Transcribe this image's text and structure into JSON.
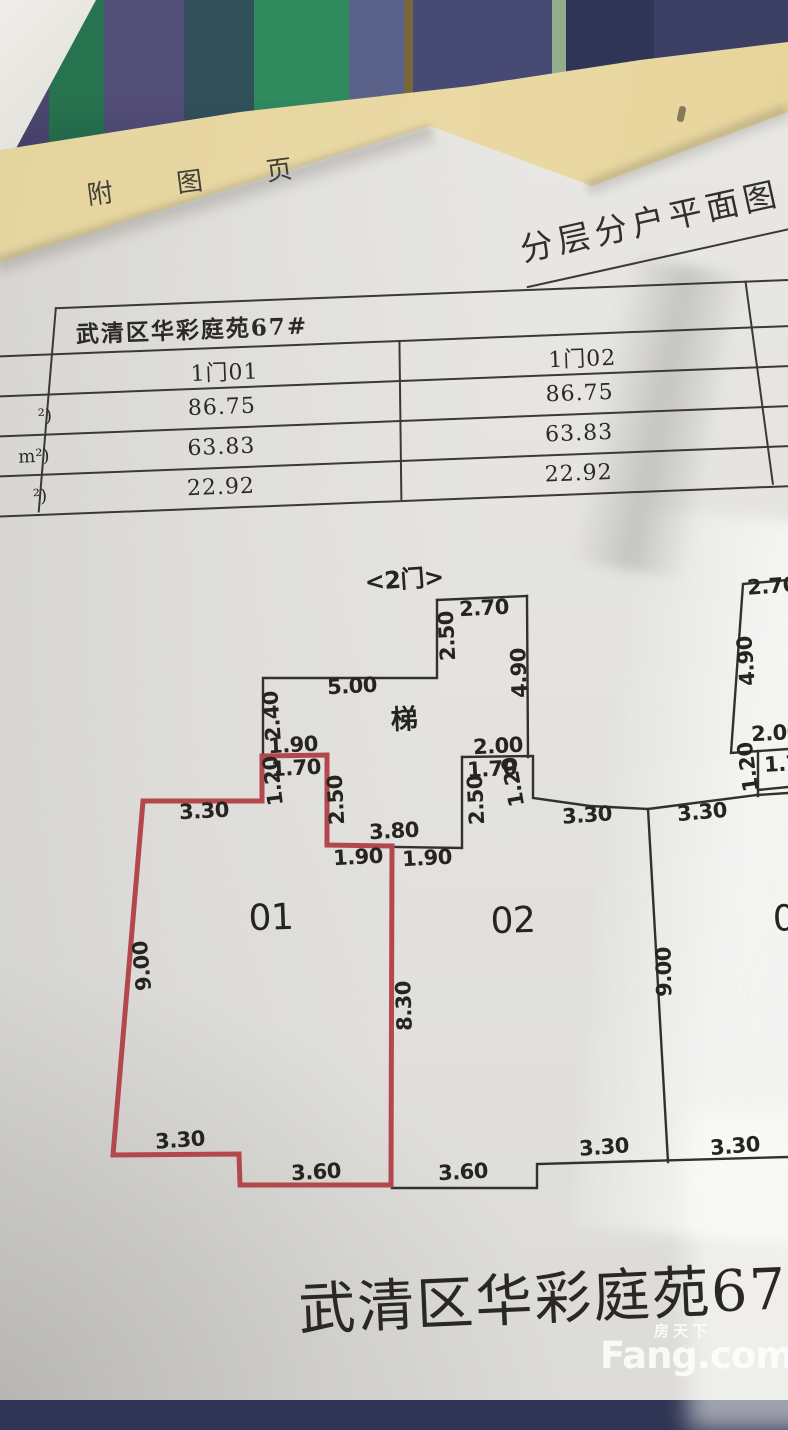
{
  "attachment_page": {
    "label": "附 图 页"
  },
  "page_title": "分层分户平面图",
  "table": {
    "building_title": "武清区华彩庭苑67#",
    "row_label_fragments": [
      "²)",
      "m²)",
      "²)"
    ],
    "columns": [
      {
        "unit": "1门01",
        "values": [
          "86.75",
          "63.83",
          "22.92"
        ]
      },
      {
        "unit": "1门02",
        "values": [
          "86.75",
          "63.83",
          "22.92"
        ]
      }
    ]
  },
  "floor_plan": {
    "entrance_label": "<2门>",
    "stair_label": "梯",
    "colors": {
      "red_wall": "#b2484e",
      "black_wall": "#33312c"
    },
    "labels": [
      {
        "t": "<2门>",
        "x": 404,
        "y": 577,
        "r": -4,
        "s": 24,
        "w": 600,
        "n": "entrance-label"
      },
      {
        "t": "2.70",
        "x": 484,
        "y": 608,
        "r": -3
      },
      {
        "t": "2.50",
        "x": 447,
        "y": 636,
        "r": -93
      },
      {
        "t": "4.90",
        "x": 519,
        "y": 673,
        "r": -92
      },
      {
        "t": "5.00",
        "x": 352,
        "y": 686,
        "r": -3
      },
      {
        "t": "梯",
        "x": 404,
        "y": 717,
        "r": -2,
        "s": 27,
        "w": 600,
        "n": "stair-label"
      },
      {
        "t": "2.40",
        "x": 272,
        "y": 716,
        "r": -94
      },
      {
        "t": "1.90",
        "x": 293,
        "y": 745,
        "r": -3
      },
      {
        "t": "2.00",
        "x": 498,
        "y": 746,
        "r": -3
      },
      {
        "t": "1.70",
        "x": 296,
        "y": 768,
        "r": -3
      },
      {
        "t": "1.20",
        "x": 273,
        "y": 781,
        "r": -97
      },
      {
        "t": "1.70",
        "x": 492,
        "y": 769,
        "r": -3
      },
      {
        "t": "1.20",
        "x": 513,
        "y": 782,
        "r": -100
      },
      {
        "t": "2.50",
        "x": 336,
        "y": 800,
        "r": -93
      },
      {
        "t": "2.50",
        "x": 476,
        "y": 800,
        "r": -93
      },
      {
        "t": "3.30",
        "x": 204,
        "y": 811,
        "r": -3
      },
      {
        "t": "3.80",
        "x": 394,
        "y": 831,
        "r": -3
      },
      {
        "t": "1.90",
        "x": 358,
        "y": 857,
        "r": -3
      },
      {
        "t": "1.90",
        "x": 427,
        "y": 858,
        "r": -3
      },
      {
        "t": "01",
        "x": 271,
        "y": 918,
        "r": -2,
        "s": 36,
        "w": 400,
        "n": "unit-01-label"
      },
      {
        "t": "9.00",
        "x": 142,
        "y": 966,
        "r": -95
      },
      {
        "t": "8.30",
        "x": 404,
        "y": 1006,
        "r": -92
      },
      {
        "t": "3.30",
        "x": 180,
        "y": 1140,
        "r": -4
      },
      {
        "t": "3.60",
        "x": 316,
        "y": 1172,
        "r": -3
      },
      {
        "t": "3.30",
        "x": 587,
        "y": 815,
        "r": -4
      },
      {
        "t": "3.30",
        "x": 702,
        "y": 812,
        "r": -5
      },
      {
        "t": "02",
        "x": 513,
        "y": 921,
        "r": -2,
        "s": 36,
        "w": 400,
        "n": "unit-02-label"
      },
      {
        "t": "9.00",
        "x": 664,
        "y": 972,
        "r": -91
      },
      {
        "t": "3.60",
        "x": 463,
        "y": 1172,
        "r": -3
      },
      {
        "t": "3.30",
        "x": 604,
        "y": 1147,
        "r": -4
      },
      {
        "t": "3.30",
        "x": 735,
        "y": 1146,
        "r": -5
      },
      {
        "t": "0",
        "x": 784,
        "y": 919,
        "r": -2,
        "s": 36,
        "w": 400,
        "n": "unit-03-label-partial"
      },
      {
        "t": "2.70",
        "x": 772,
        "y": 586,
        "r": -4
      },
      {
        "t": "4.90",
        "x": 746,
        "y": 661,
        "r": -94
      },
      {
        "t": "2.00",
        "x": 776,
        "y": 733,
        "r": -3
      },
      {
        "t": "1.20",
        "x": 748,
        "y": 767,
        "r": -98
      },
      {
        "t": "1.7",
        "x": 782,
        "y": 764,
        "r": -3
      }
    ]
  },
  "footer": {
    "caption": "武清区华彩庭苑67#3"
  },
  "watermark": {
    "cn": "房天下",
    "en": "Fang.com"
  }
}
